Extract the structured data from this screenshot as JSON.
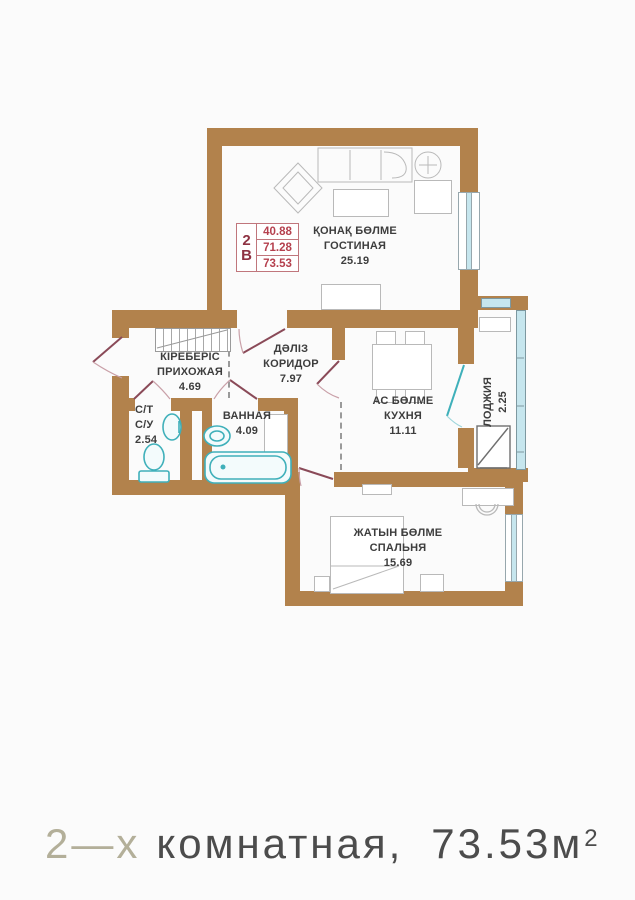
{
  "plan": {
    "unit_box": {
      "unit": [
        "2",
        "В"
      ],
      "values": [
        "40.88",
        "71.28",
        "73.53"
      ]
    },
    "rooms": {
      "living": {
        "name_kz": "ҚОНАҚ БӨЛМЕ",
        "name_ru": "ГОСТИНАЯ",
        "area": "25.19"
      },
      "hallway": {
        "name_kz": "КІРЕБЕРІС",
        "name_ru": "ПРИХОЖАЯ",
        "area": "4.69"
      },
      "corridor": {
        "name_kz": "ДӘЛІЗ",
        "name_ru": "КОРИДОР",
        "area": "7.97"
      },
      "kitchen": {
        "name_kz": "АС БӨЛМЕ",
        "name_ru": "КУХНЯ",
        "area": "11.11"
      },
      "wc": {
        "name_line1": "С/Т",
        "name_line2": "С/У",
        "area": "2.54"
      },
      "bathroom": {
        "name_ru": "ВАННАЯ",
        "area": "4.09"
      },
      "loggia": {
        "name_ru": "ЛОДЖИЯ",
        "area": "2.25"
      },
      "bedroom": {
        "name_kz": "ЖАТЫН БӨЛМЕ",
        "name_ru": "СПАЛЬНЯ",
        "area": "15.69"
      }
    },
    "colors": {
      "wall": "#b2824c",
      "window": "#c6e6ee",
      "fixture": "#3fb0ba",
      "door": "#8a4a58",
      "accent_red": "#c0767c"
    }
  },
  "caption": {
    "prefix": "2—х",
    "text": "комнатная,",
    "area": "73.53",
    "unit": "м",
    "sup": "2"
  }
}
